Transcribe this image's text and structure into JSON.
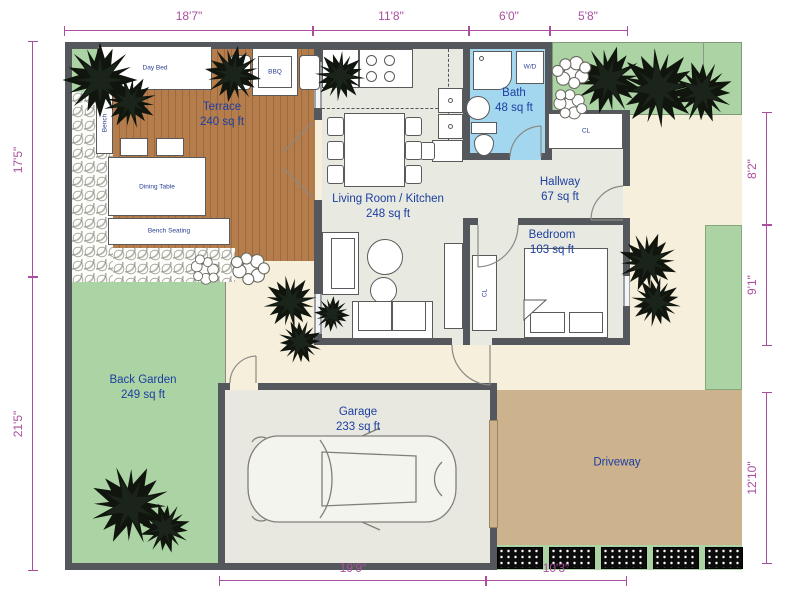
{
  "title": "Floor plan with garden, garage and driveway",
  "rooms": [
    {
      "name": "Terrace",
      "area": "240 sq ft"
    },
    {
      "name": "Living Room / Kitchen",
      "area": "248 sq ft"
    },
    {
      "name": "Bath",
      "area": "48 sq ft"
    },
    {
      "name": "Hallway",
      "area": "67 sq ft"
    },
    {
      "name": "Bedroom",
      "area": "103 sq ft"
    },
    {
      "name": "Back Garden",
      "area": "249 sq ft"
    },
    {
      "name": "Garage",
      "area": "233 sq ft"
    },
    {
      "name": "Driveway",
      "area": ""
    }
  ],
  "furniture": {
    "day_bed": "Day Bed",
    "bbq": "BBQ",
    "bench": "Bench",
    "dining_table": "Dining Table",
    "bench_seating": "Bench Seating",
    "fridge": "R/F",
    "washer_dryer": "W/D",
    "hall_closet": "CL",
    "bedroom_closet": "CL"
  },
  "dimensions": {
    "top": [
      "18'7\"",
      "11'8\"",
      "6'0\"",
      "5'8\""
    ],
    "left": [
      "17'5\"",
      "21'5\""
    ],
    "right": [
      "8'2\"",
      "9'1\"",
      "12'10\""
    ],
    "bottom": [
      "19'9\"",
      "10'3\""
    ]
  },
  "colors": {
    "wall": "#54585c",
    "dimension": "#a94f9e",
    "room_label": "#1c3fa0",
    "garden_green": "#abd3a3",
    "terrace_wood": "#b57c4c",
    "bath_blue": "#a3d7f0",
    "interior_floor": "#e8e9e1",
    "path_cream": "#f6efdb",
    "driveway_tan": "#cdb28e"
  }
}
